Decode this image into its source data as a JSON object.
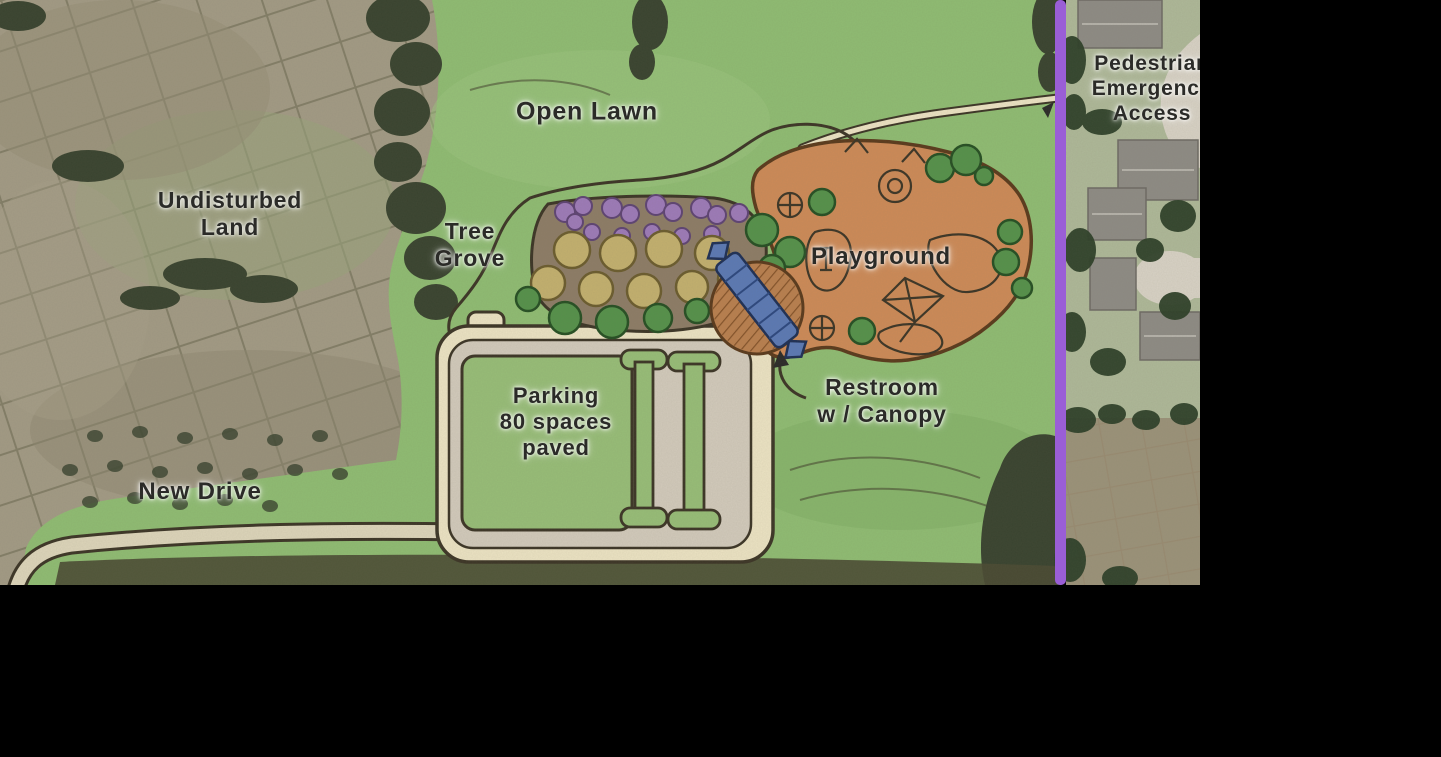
{
  "map": {
    "title": "Park concept site plan over aerial photo",
    "labels": {
      "open_lawn": "Open Lawn",
      "undisturbed_land": "Undisturbed\nLand",
      "tree_grove": "Tree\nGrove",
      "playground": "Playground",
      "parking": "Parking\n80 spaces\npaved",
      "restroom": "Restroom\nw / Canopy",
      "new_drive": "New Drive",
      "pedestrian_access": "Pedestrian\nEmergency\nAccess"
    },
    "features": [
      "open-lawn",
      "undisturbed-land",
      "tree-grove",
      "playground",
      "parking-lot",
      "restroom-with-canopy",
      "new-drive",
      "pedestrian-emergency-access",
      "property-boundary"
    ],
    "parking_spaces": "80"
  },
  "colors": {
    "background": "#000000",
    "ink": "#2b2b28",
    "outline_dark": "#3c3526",
    "lawn_green": "#8fbc72",
    "playground_orange": "#cd8a57",
    "path_cream": "#ece3c3",
    "pavement_gray": "#d2cabb",
    "grove_soil": "#8d7c66",
    "tree_green": "#55914a",
    "tree_khaki": "#c3b06e",
    "tree_purple": "#9d7ab8",
    "canopy_blue": "#5b79b4",
    "terrace_brown": "#b97f4e",
    "boundary_purple": "#9a5ed6",
    "aerial_field": "#a29a84",
    "aerial_dark_trees": "#39432f",
    "hedgerow": "#4a4a33",
    "garden_tan": "#b2a285",
    "garden_plot": "#8d5038",
    "residential_lawn": "#aeb898",
    "residential_field": "#9b9279",
    "roof_gray": "#8e8b84",
    "road_light": "#d8d2c5"
  }
}
